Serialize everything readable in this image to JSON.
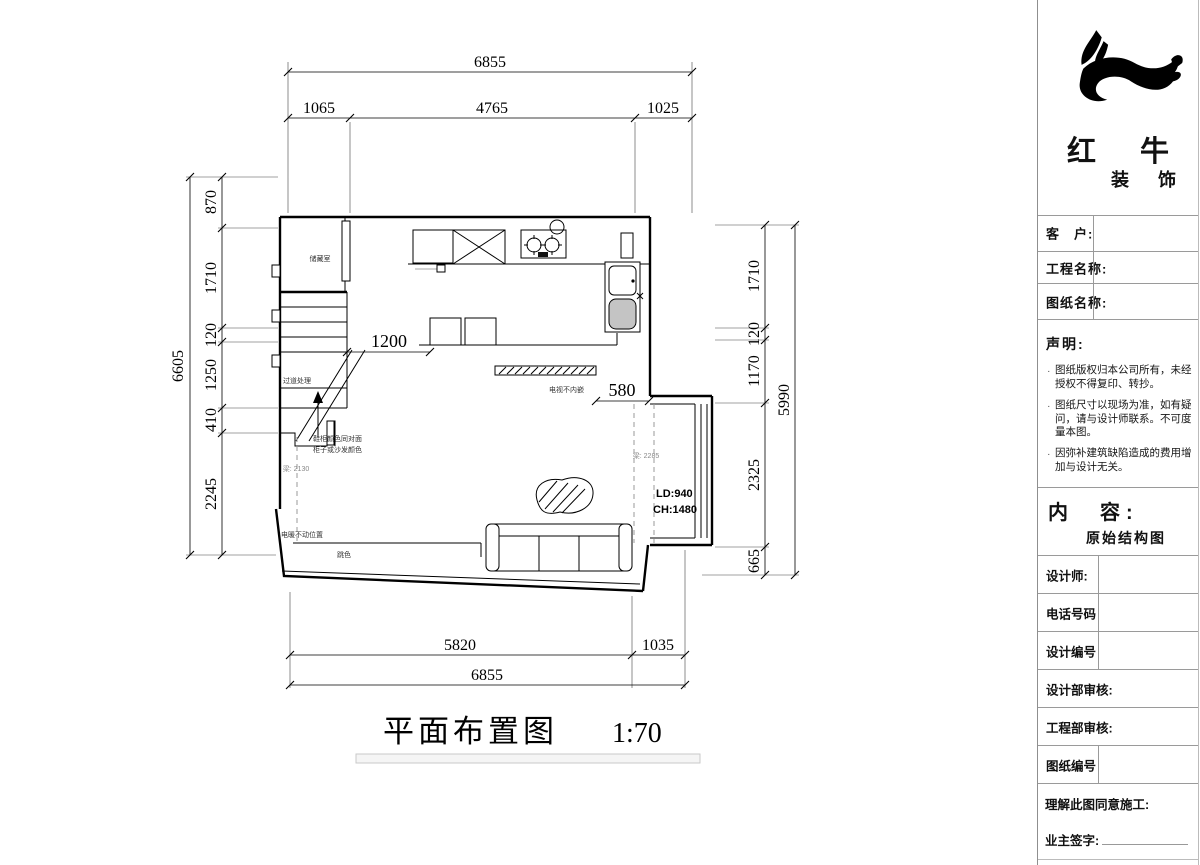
{
  "drawing": {
    "title": "平面布置图",
    "scale": "1:70"
  },
  "dims": {
    "top_total": "6855",
    "top_segs": [
      "1065",
      "4765",
      "1025"
    ],
    "left_total": "6605",
    "left_segs": [
      "870",
      "1710",
      "120",
      "1250",
      "410",
      "2245"
    ],
    "right_total": "5990",
    "right_segs": [
      "1710",
      "120",
      "1170",
      "2325",
      "665"
    ],
    "bottom_segs": [
      "5820",
      "1035"
    ],
    "bottom_total": "6855"
  },
  "plan": {
    "storage_label": "储藏室",
    "corridor_label": "过道处理",
    "dim_1200": "1200",
    "dim_580": "580",
    "tv_label": "电视不内嵌",
    "beam_left": "梁: 2130",
    "beam_right": "梁: 2285",
    "color_note_1": "鞋柜颜色同对面",
    "color_note_2": "柜子或沙发颜色",
    "heater_label": "电暖不动位置",
    "accent_label": "跳色",
    "ld_label": "LD:940",
    "ch_label": "CH:1480"
  },
  "titleblock": {
    "brand_line1": "红 牛",
    "brand_line2": "装 饰",
    "fields": [
      "客　户:",
      "工程名称:",
      "图纸名称:"
    ],
    "statement_title": "声明:",
    "statement_items": [
      "图纸版权归本公司所有，未经授权不得复印、转抄。",
      "图纸尺寸以现场为准，如有疑问，请与设计师联系。不可度量本图。",
      "因弥补建筑缺陷造成的费用增加与设计无关。"
    ],
    "content_label": "内　容:",
    "content_value": "原始结构图",
    "rows": [
      "设计师:",
      "电话号码",
      "设计编号",
      "设计部审核:",
      "工程部审核:",
      "图纸编号"
    ],
    "agree_label": "理解此图同意施工:",
    "sign_label": "业主签字:"
  }
}
